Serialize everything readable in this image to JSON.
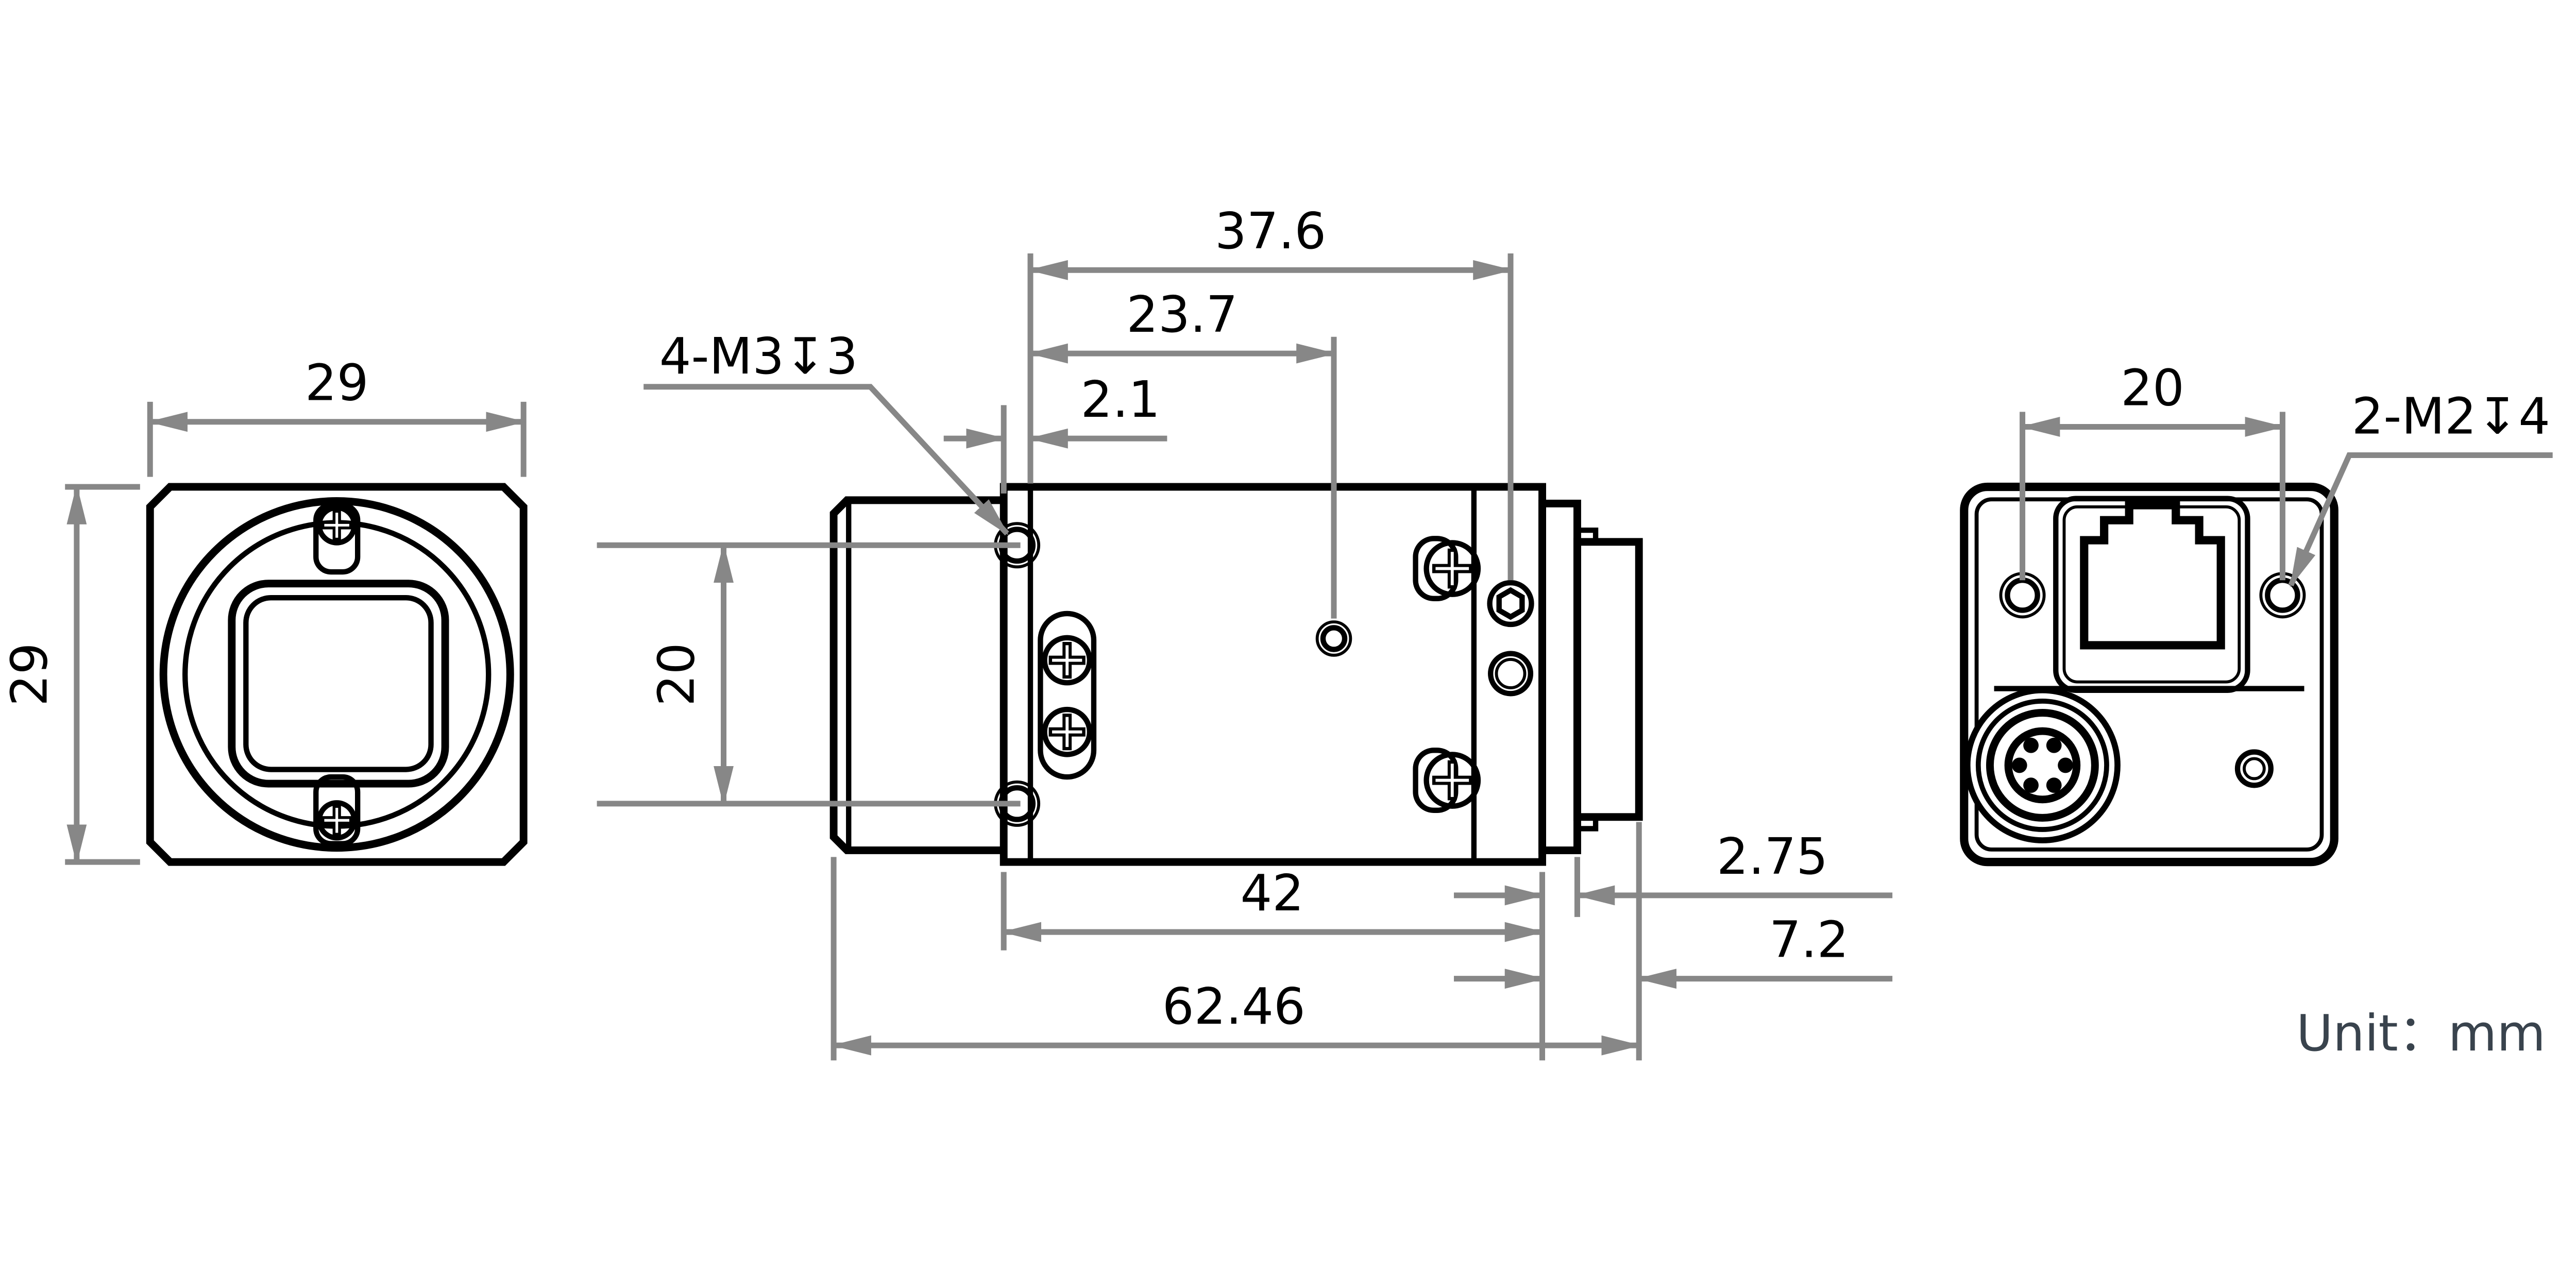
{
  "drawing": {
    "type": "mechanical-dimension-drawing",
    "unit_note": "Unit：mm",
    "colors": {
      "outline": "#000000",
      "dimension": "#878787",
      "unit_text": "#39434d"
    },
    "front_view": {
      "dim_width": "29",
      "dim_height": "29"
    },
    "side_view": {
      "label_mount_screws": "4-M3↧3",
      "dim_front_to_rear_holes": "37.6",
      "dim_front_to_center_hole": "23.7",
      "dim_flange_thickness": "2.1",
      "dim_hole_spacing": "20",
      "dim_body_length": "42",
      "dim_rear_plate": "2.75",
      "dim_connector_length": "7.2",
      "dim_total_length": "62.46"
    },
    "back_view": {
      "dim_hole_spacing": "20",
      "label_rear_screws": "2-M2↧4"
    }
  }
}
